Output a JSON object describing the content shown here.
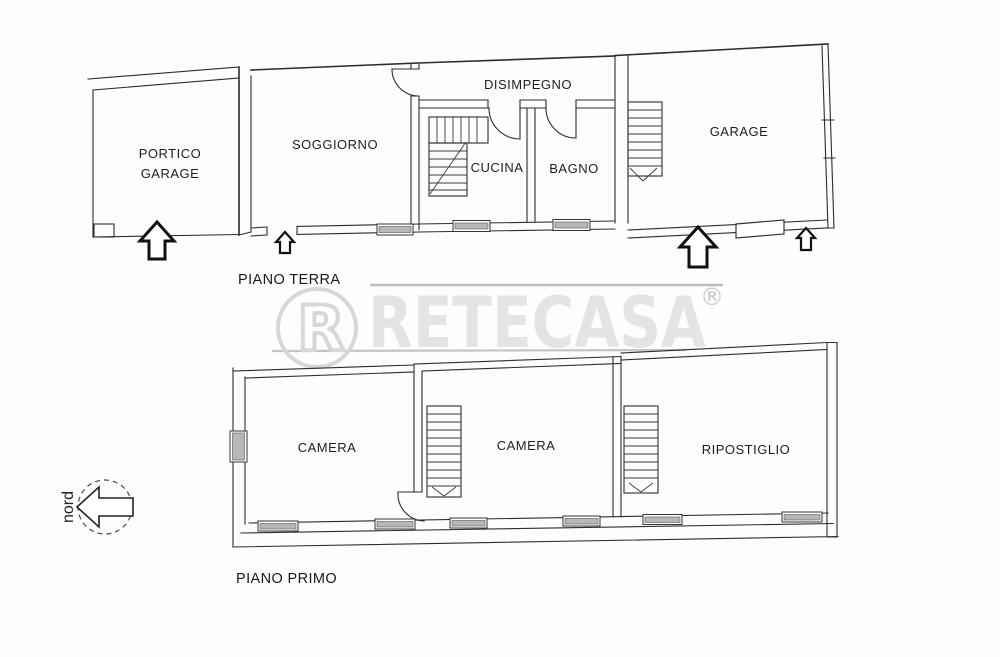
{
  "document": {
    "kind": "real-estate floor plan",
    "background": "#fdfdfd"
  },
  "colors": {
    "plan_line": "#2d2d2d",
    "label_text": "#1e1e1e",
    "watermark_text": "#e4e4e4",
    "watermark_logo": "#d7d7d7",
    "watermark_rule": "#bcbcbc",
    "window_hatch": "#b7b7b7"
  },
  "watermark": {
    "brand": "RETECASA",
    "registered_mark": "®",
    "logo_letter": "R"
  },
  "compass": {
    "label": "nord"
  },
  "icons": {
    "entrance_large": "block-arrow-up",
    "entrance_small": "block-arrow-up-small",
    "north": "block-arrow-left"
  },
  "floors": [
    {
      "caption": "PIANO TERRA",
      "rooms": [
        {
          "label_line1": "PORTICO",
          "label_line2": "GARAGE"
        },
        {
          "label": "SOGGIORNO"
        },
        {
          "label": "DISIMPEGNO"
        },
        {
          "label": "CUCINA"
        },
        {
          "label": "BAGNO"
        },
        {
          "label": "GARAGE"
        }
      ]
    },
    {
      "caption": "PIANO PRIMO",
      "rooms": [
        {
          "label": "CAMERA"
        },
        {
          "label": "CAMERA"
        },
        {
          "label": "RIPOSTIGLIO"
        }
      ]
    }
  ]
}
